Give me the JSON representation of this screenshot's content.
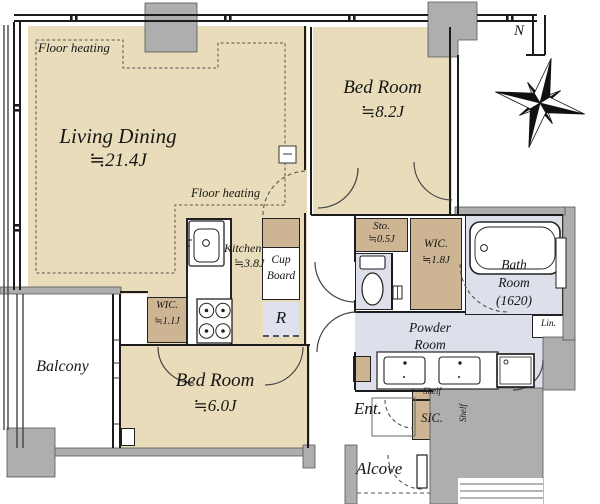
{
  "plan": {
    "compass": {
      "north_label": "N"
    },
    "annotations": {
      "floor_heating_living": "Floor heating",
      "floor_heating_kitchen": "Floor heating"
    },
    "rooms": {
      "living_dining": {
        "name": "Living Dining",
        "size": "≒21.4J"
      },
      "bedroom_main": {
        "name": "Bed Room",
        "size": "≒8.2J"
      },
      "bedroom_second": {
        "name": "Bed Room",
        "size": "≒6.0J"
      },
      "kitchen": {
        "name": "Kitchen",
        "size": "≒3.8J"
      },
      "bath": {
        "line1": "Bath",
        "line2": "Room",
        "line3": "(1620)"
      },
      "powder_room": {
        "line1": "Powder",
        "line2": "Room"
      },
      "balcony": {
        "name": "Balcony"
      },
      "entrance": {
        "name": "Ent."
      },
      "alcove": {
        "name": "Alcove"
      }
    },
    "storage": {
      "wic_small": {
        "name": "WIC.",
        "size": "≒1.1J"
      },
      "wic_large": {
        "name": "WIC.",
        "size": "≒1.8J"
      },
      "storage_small": {
        "name": "Sto.",
        "size": "≒0.5J"
      },
      "cupboard": {
        "line1": "Cup",
        "line2": "Board"
      },
      "refrigerator": {
        "label": "R"
      },
      "linen": {
        "label": "Lin."
      },
      "shoe_closet": {
        "label": "SIC."
      },
      "shelf_top": {
        "label": "Shelf"
      },
      "shelf_side": {
        "label": "Shelf"
      }
    },
    "colors": {
      "room_floor": "#e8dcba",
      "closet_fill": "#cdb493",
      "wet_area": "#dde0ea",
      "wall_gray": "#aeaeae",
      "line": "#1c1c1c"
    }
  }
}
